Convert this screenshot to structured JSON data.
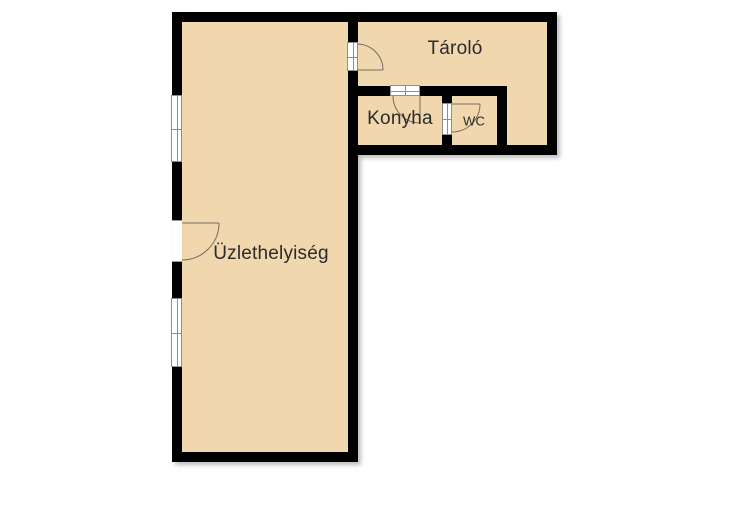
{
  "colors": {
    "background": "#ffffff",
    "wall": "#000000",
    "room_fill": "#f0d7ae",
    "label": "#2b2b2b",
    "symbol_line": "#6f6f63",
    "symbol_frame": "#8f8f8f"
  },
  "rooms": [
    {
      "id": "uzlethelyiseg",
      "label": "Üzlethelyiség"
    },
    {
      "id": "tarolo",
      "label": "Tároló"
    },
    {
      "id": "konyha",
      "label": "Konyha"
    },
    {
      "id": "wc",
      "label": "WC"
    }
  ],
  "symbols": {
    "windows_count": 2,
    "doors_count": 4
  }
}
